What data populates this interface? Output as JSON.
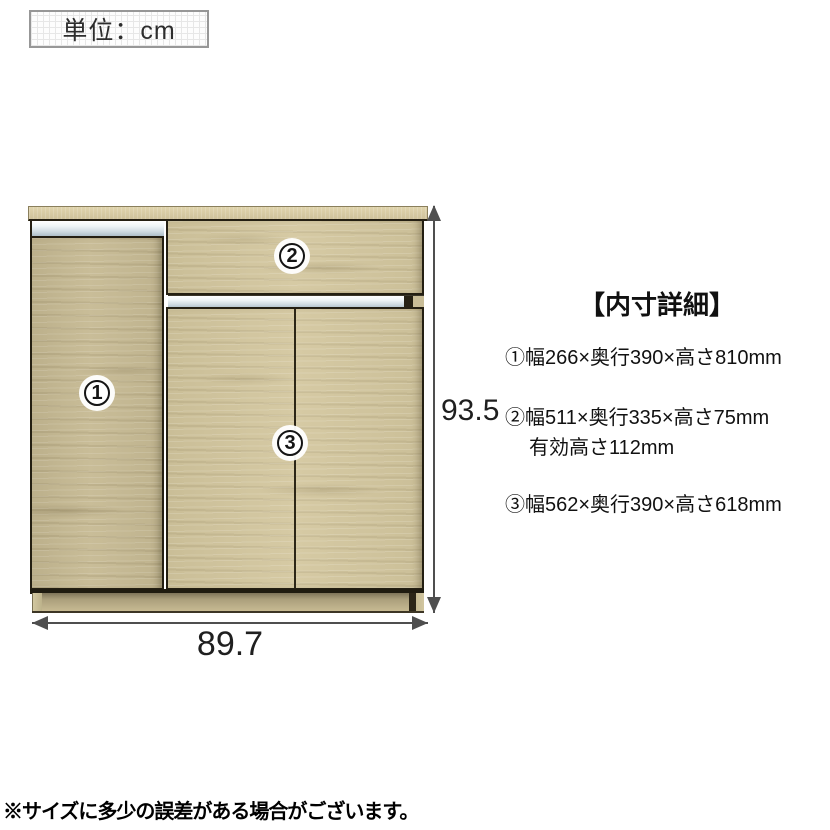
{
  "unit_box": {
    "label": "単位：cm"
  },
  "cabinet": {
    "marker1": "1",
    "marker2": "2",
    "marker3": "3"
  },
  "dimensions": {
    "width_cm": "89.7",
    "height_cm": "93.5"
  },
  "details": {
    "title": "【内寸詳細】",
    "item1": "①幅266×奥行390×高さ810mm",
    "item2": "②幅511×奥行335×高さ75mm",
    "item2_sub": "有効高さ112mm",
    "item3": "③幅562×奥行390×高さ618mm"
  },
  "footnote": "※サイズに多少の誤差がある場合がございます。",
  "colors": {
    "wood_light": "#d0c49e",
    "wood_mid": "#c4b894",
    "outline": "#241f12",
    "metal_trim": "#cfdbe1",
    "dimension_line": "#4f4f4f",
    "background": "#ffffff"
  }
}
